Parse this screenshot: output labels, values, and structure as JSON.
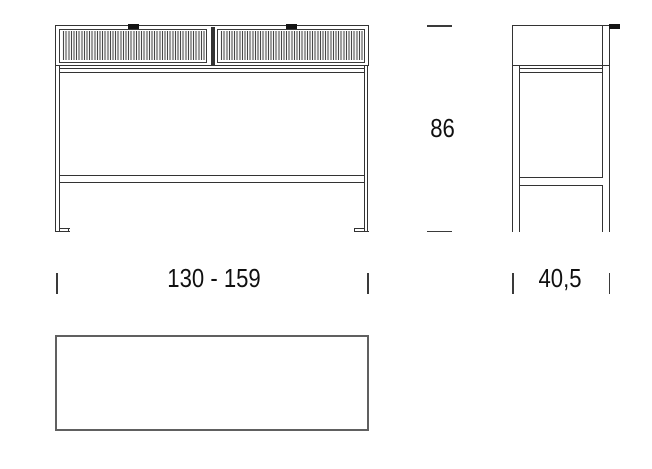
{
  "dimensions": {
    "height": "86",
    "width_range": "130 - 159",
    "depth": "40,5"
  },
  "colors": {
    "background": "#ffffff",
    "line": "#333333",
    "handle": "#141414",
    "top_view_outline": "#606060"
  }
}
